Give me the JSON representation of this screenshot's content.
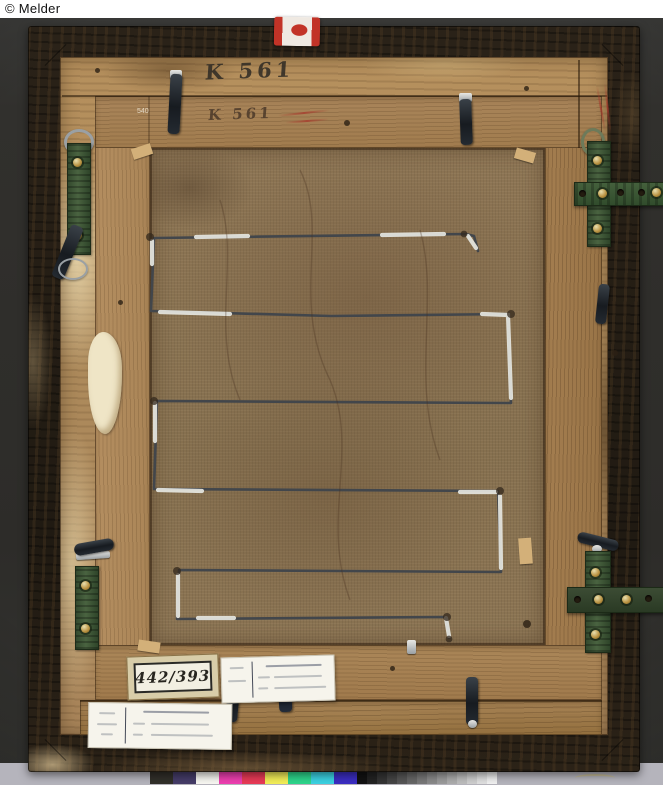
{
  "credit_line": "© Melder",
  "photo": {
    "subject": "Verso of a framed painting: wooden frame back, stretcher with serpentine hanging wire, hanger hardware and museum labels",
    "background_color": "#2f2e2b"
  },
  "inscriptions": {
    "frame_number_top": "K 561",
    "stretcher_number": "K 561",
    "small_stamp": "540"
  },
  "labels": {
    "inventory_number": "442/393"
  },
  "colors": {
    "hardware_green": "#41573a",
    "wire_dark": "#42464b",
    "tape_white": "#e6e7e1",
    "canvas_brown": "#8b7453",
    "frame_wood_tan": "#ad8a5b",
    "moulding_dark": "#241d14"
  },
  "color_chart": {
    "swatches": [
      "#31302a",
      "#453c68",
      "#f8f7f2",
      "#ee3fb0",
      "#e93a57",
      "#f3ee58",
      "#2ed68c",
      "#3bd2e2",
      "#3b2ec2"
    ],
    "grayscale": {
      "from_shade": 18,
      "to_shade": 240,
      "steps": 14
    },
    "background": "#b5b4bc"
  }
}
